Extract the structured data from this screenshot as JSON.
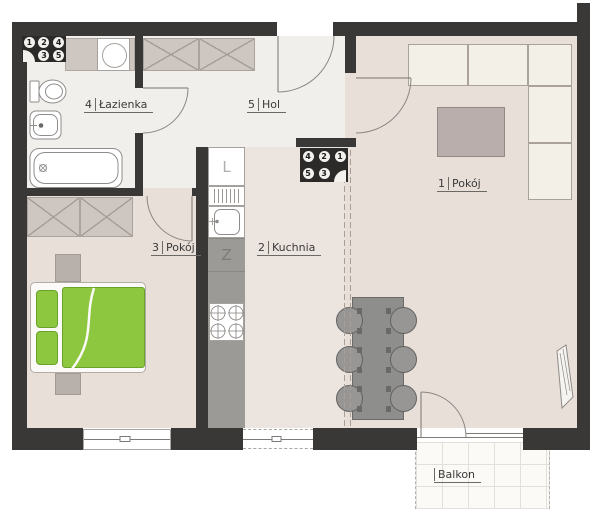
{
  "rooms": [
    {
      "num": "1",
      "name": "Pokój"
    },
    {
      "num": "2",
      "name": "Kuchnia"
    },
    {
      "num": "3",
      "name": "Pokój"
    },
    {
      "num": "4",
      "name": "Łazienka"
    },
    {
      "num": "5",
      "name": "Hol"
    }
  ],
  "balcony": {
    "name": "Balkon"
  },
  "badges": {
    "top_left": {
      "row1": [
        "1",
        "2",
        "4"
      ],
      "row2": [
        "3",
        "5"
      ]
    },
    "kitchen": {
      "row1": [
        "4",
        "2",
        "1"
      ],
      "row2": [
        "5",
        "3"
      ]
    }
  },
  "appliances": {
    "fridge_letter": "L",
    "dishwasher_letter": "Z"
  },
  "colors": {
    "wall": "#3a3836",
    "floor_warm": "#e9dfd9",
    "floor_light": "#f0efeb",
    "bed_green": "#8dc63f",
    "furniture_taupe": "#cdc6c1",
    "counter_gray": "#9c9a97",
    "sofa_cream": "#f3f0e8"
  }
}
